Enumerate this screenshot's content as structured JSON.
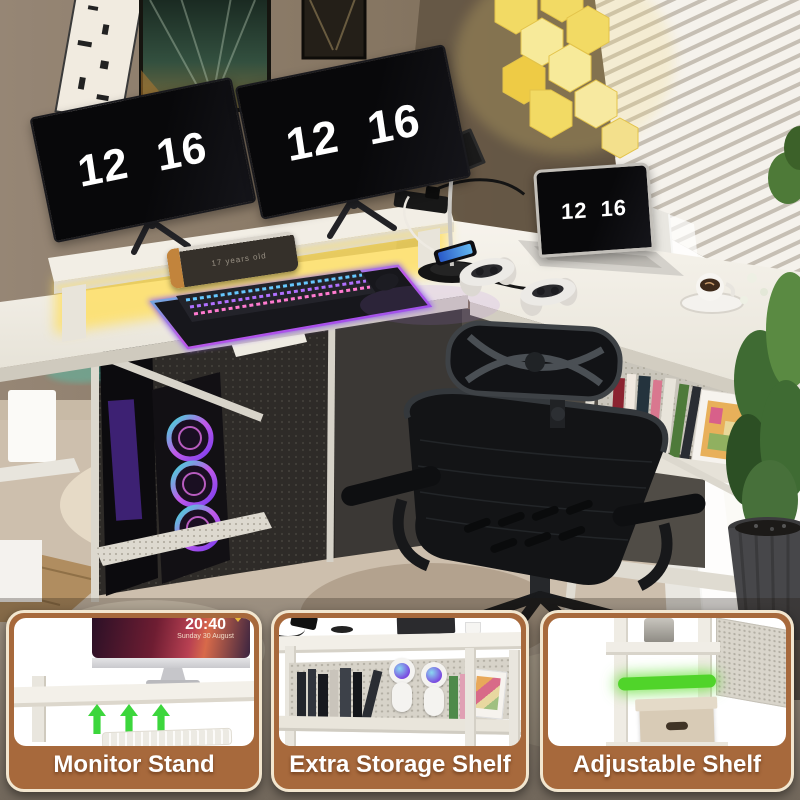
{
  "scene": {
    "left_monitor": {
      "time": "12 16"
    },
    "right_monitor": {
      "time": "12 16"
    },
    "laptop": {
      "time": "12 16"
    },
    "speaker": {
      "label": "17 years old"
    },
    "colors": {
      "accent_brown": "#a7693c",
      "led_strip_yellow": "#ffe15e",
      "rgb_glow_purple": "#b264e8",
      "arrow_green": "#3cd63c",
      "shelf_green": "#50d42a",
      "hex_light_yellow": "#f5dc6a",
      "desk_white": "#f3efe6"
    }
  },
  "panels": [
    {
      "label": "Monitor Stand",
      "screen_time": "20:40",
      "screen_date": "Sunday 30 August",
      "arrow_icons": [
        "up-arrow",
        "up-arrow",
        "up-arrow"
      ]
    },
    {
      "label": "Extra Storage Shelf"
    },
    {
      "label": "Adjustable Shelf"
    }
  ]
}
